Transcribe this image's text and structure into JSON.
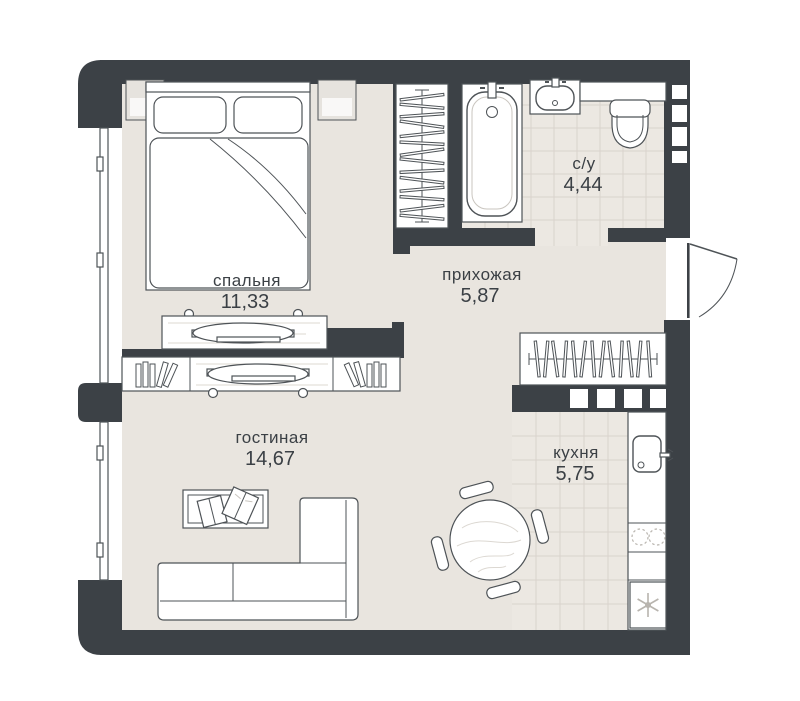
{
  "plan": {
    "type": "apartment-floor-plan",
    "rooms": [
      {
        "id": "bedroom",
        "name": "спальня",
        "area": "11,33"
      },
      {
        "id": "hallway",
        "name": "прихожая",
        "area": "5,87"
      },
      {
        "id": "bathroom",
        "name": "с/у",
        "area": "4,44"
      },
      {
        "id": "living-room",
        "name": "гостиная",
        "area": "14,67"
      },
      {
        "id": "kitchen",
        "name": "кухня",
        "area": "5,75"
      }
    ],
    "fixtures": [
      "bed-icon",
      "pillow-icon",
      "nightstand-icon",
      "wardrobe-hangers-icon",
      "bathtub-icon",
      "washbasin-icon",
      "toilet-icon",
      "hall-wardrobe-hangers-icon",
      "kitchen-counter-icon",
      "kitchen-sink-icon",
      "stove-burners-icon",
      "fridge-snowflake-icon",
      "dining-table-icon",
      "chair-icon",
      "corner-sofa-icon",
      "coffee-table-icon",
      "tv-console-icon",
      "bookshelf-icon",
      "entrance-door-swing-icon",
      "window-icon",
      "vent-shaft-icon"
    ],
    "colors": {
      "wall": "#3c4146",
      "floor": "#e9e5df",
      "tile": "#ece8e2",
      "tile_line": "#d9d3cc",
      "line": "#4e5357",
      "light": "#e6e3de",
      "text": "#3b4045",
      "bg": "#ffffff"
    }
  }
}
